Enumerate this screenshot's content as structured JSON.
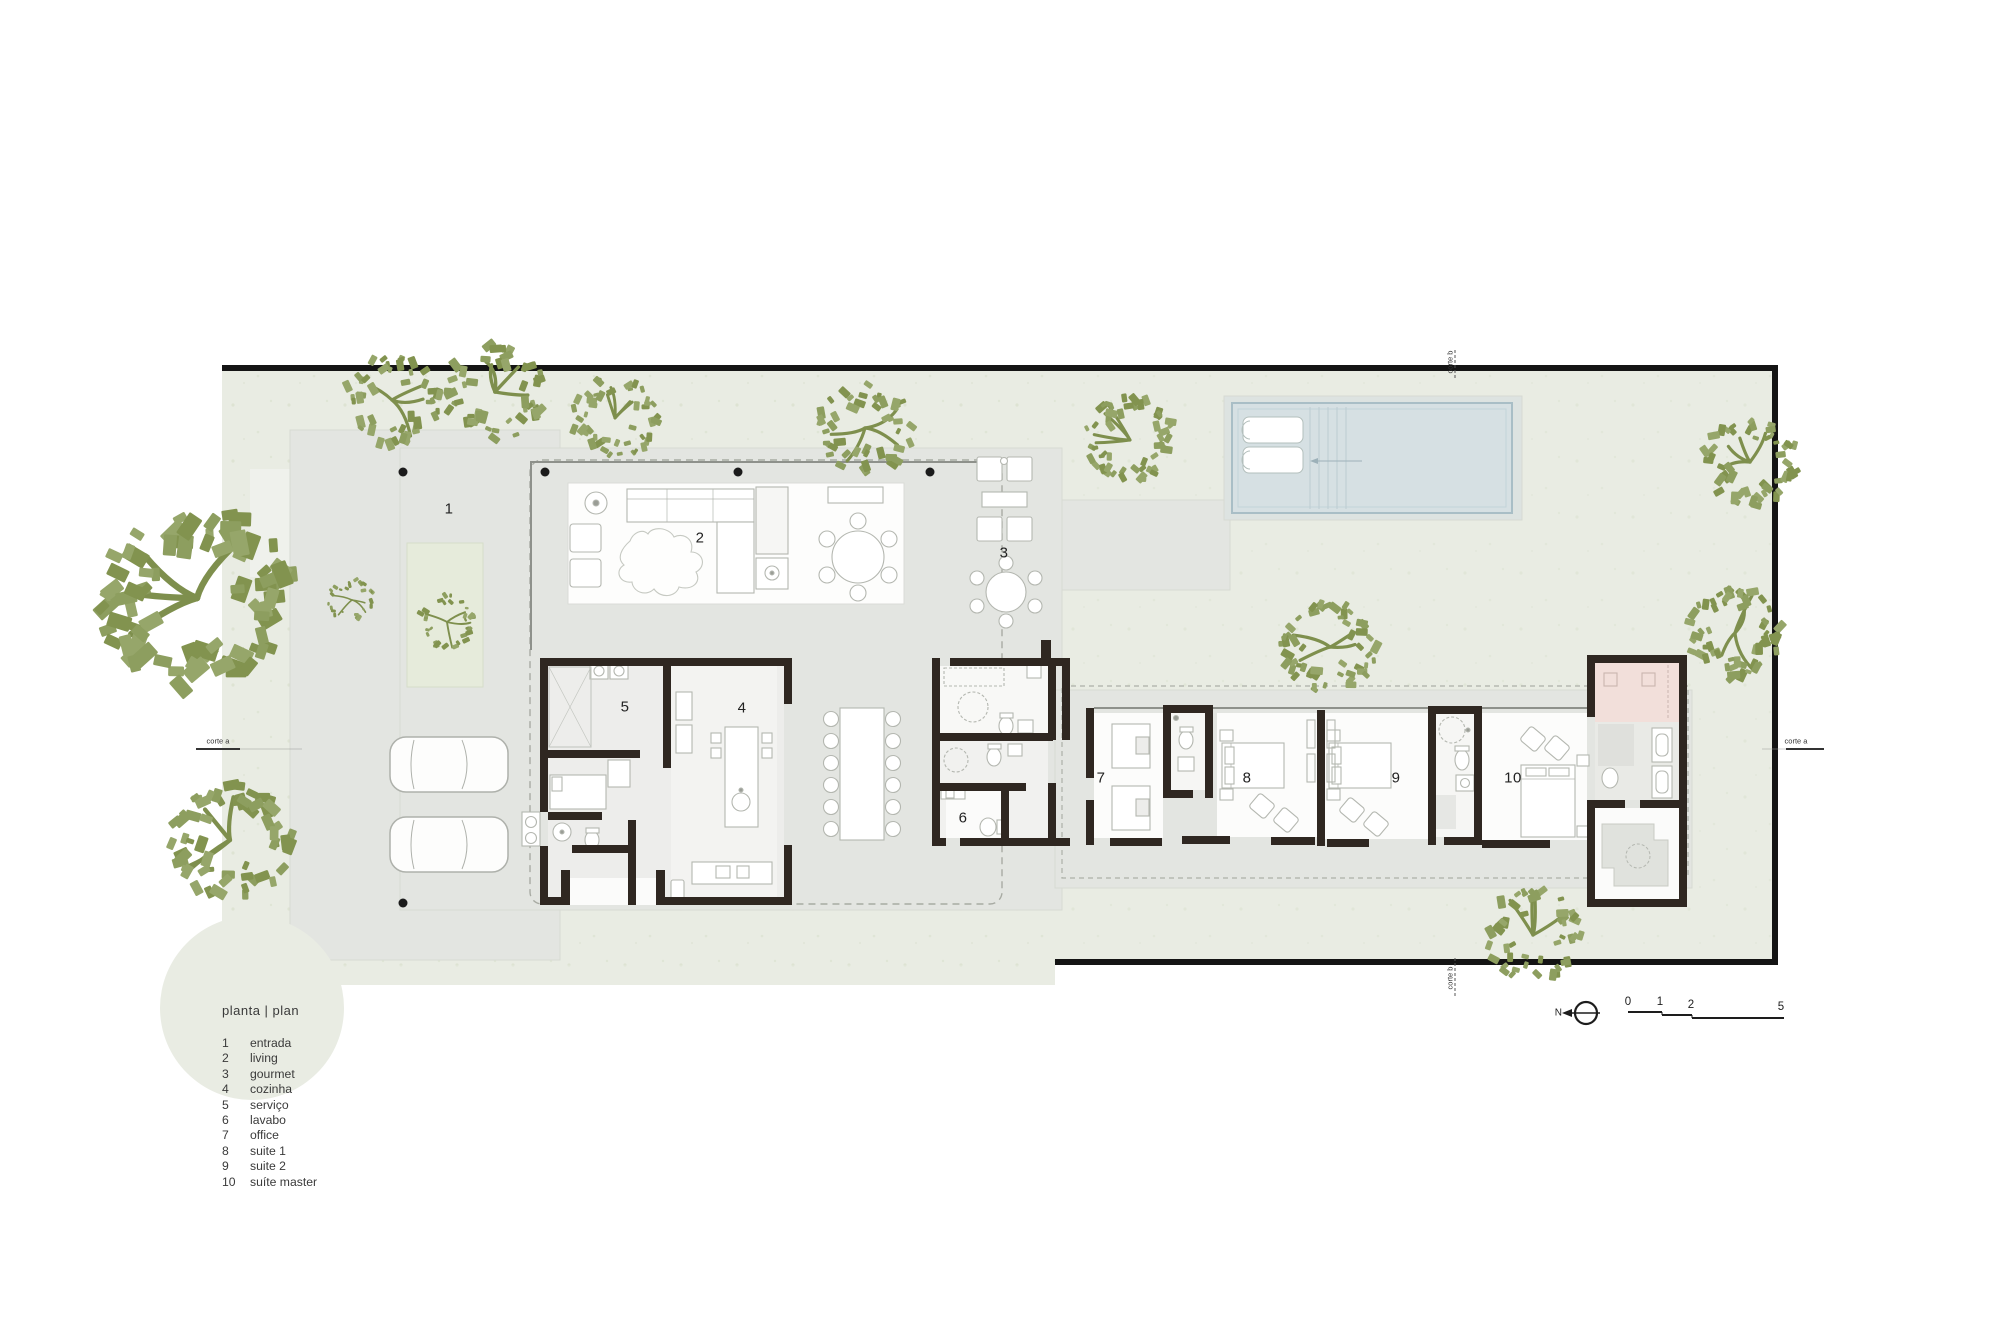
{
  "legend": {
    "heading": "planta | plan",
    "items": [
      {
        "num": "1",
        "label": "entrada"
      },
      {
        "num": "2",
        "label": "living"
      },
      {
        "num": "3",
        "label": "gourmet"
      },
      {
        "num": "4",
        "label": "cozinha"
      },
      {
        "num": "5",
        "label": "serviço"
      },
      {
        "num": "6",
        "label": "lavabo"
      },
      {
        "num": "7",
        "label": "office"
      },
      {
        "num": "8",
        "label": "suite 1"
      },
      {
        "num": "9",
        "label": "suite 2"
      },
      {
        "num": "10",
        "label": "suíte master"
      }
    ]
  },
  "plan": {
    "room_labels": [
      "1",
      "2",
      "3",
      "4",
      "5",
      "6",
      "7",
      "8",
      "9",
      "10"
    ]
  },
  "annotations": {
    "section_a_left": "corte a",
    "section_a_right": "corte a",
    "section_b_top": "corte b",
    "section_b_bottom": "corte b",
    "north_label": "N"
  },
  "scale_bar": {
    "ticks": [
      "0",
      "1",
      "2",
      "5"
    ]
  },
  "colors": {
    "site_green": "#e9ece3",
    "paving_gray": "#e3e5e1",
    "wall_dark": "#2f2721",
    "tree_green": "#8d9e5f",
    "pool_fill": "#d6e0e3",
    "closet_pink": "#f2dfda",
    "boundary_black": "#141414"
  }
}
